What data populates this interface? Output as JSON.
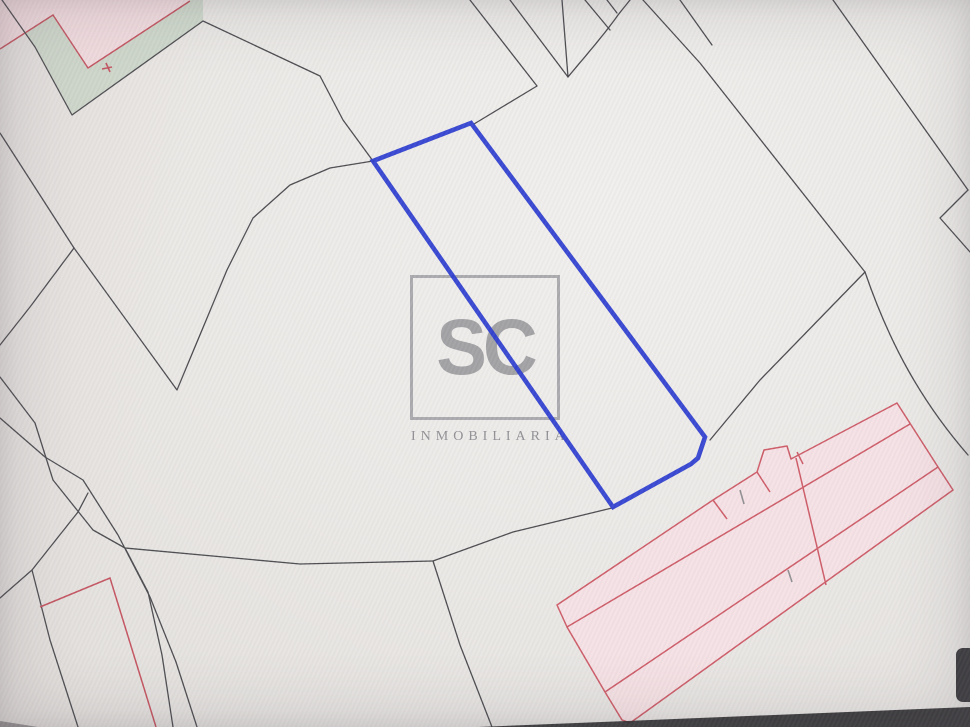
{
  "window": {
    "description": "Photographed computer screen showing a cadastral parcel map with one parcel highlighted in blue"
  },
  "logo": {
    "monogram": "SC",
    "subtitle": "INMOBILIARIA"
  },
  "colors": {
    "background": "#ebe9e6",
    "boundary": "#4a4a4e",
    "parcel_blue": "#2838cf",
    "parcel_red": "#c4525e",
    "building_stroke": "#cd5a66",
    "building_fill": "#f6e0e4",
    "zone_pink": "#f3dee1",
    "zone_green": "#cfd9cc",
    "logo_gray": "#9c9ca0",
    "screen_dark": "#2b2a2c",
    "tick_gray": "#8f8f92"
  }
}
